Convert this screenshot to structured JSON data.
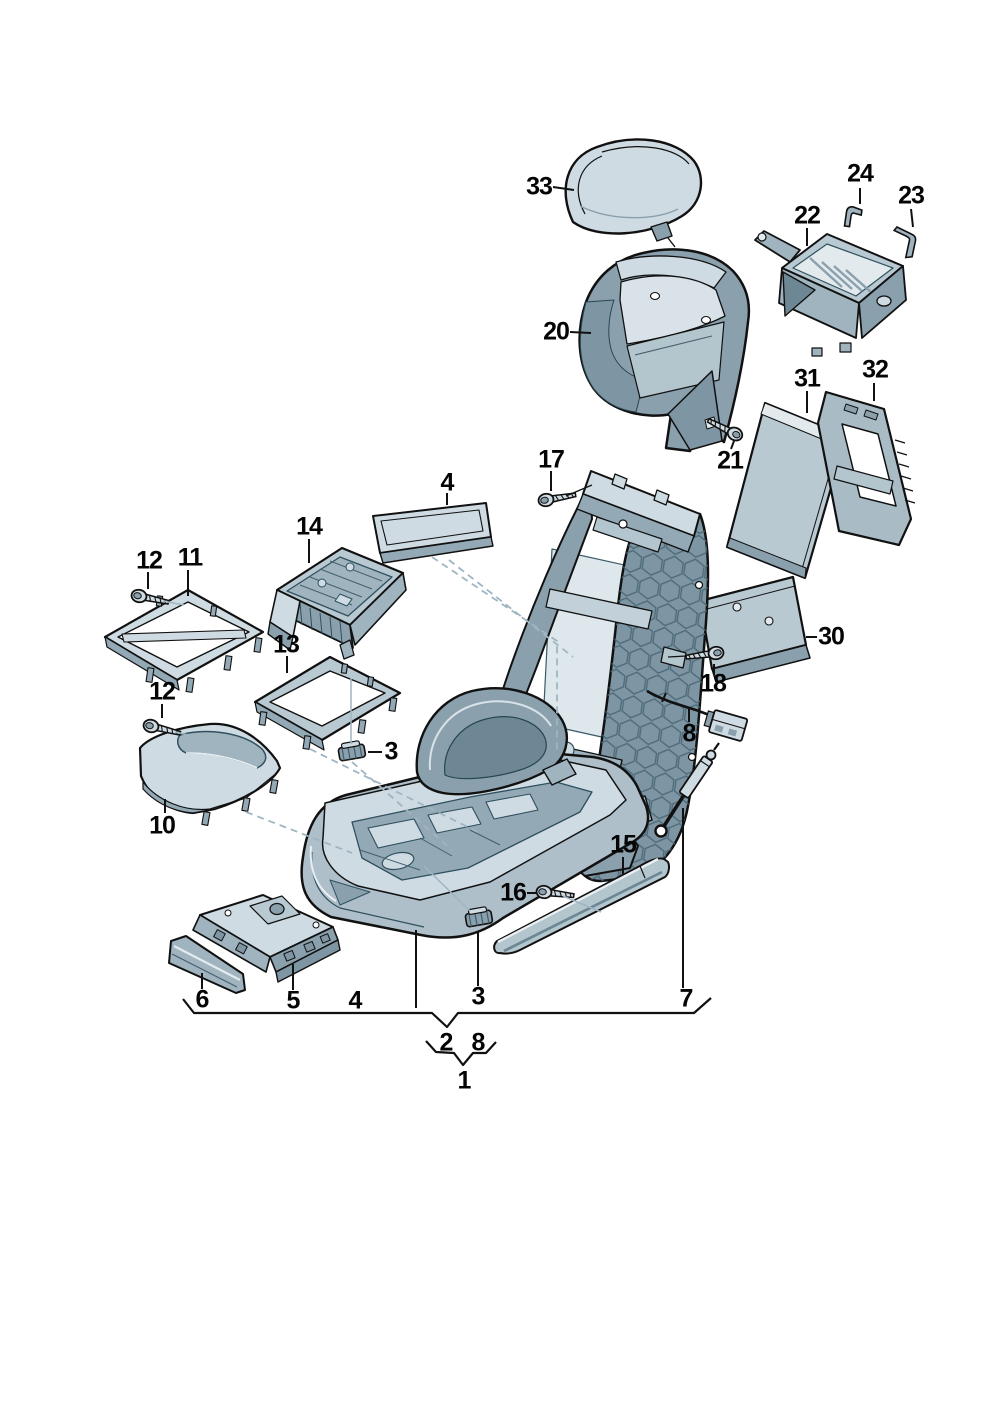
{
  "diagram": {
    "type": "exploded-parts-diagram",
    "background": "#ffffff",
    "colors": {
      "outline": "#111111",
      "part_light": "#cfdbe2",
      "part_lighter": "#e2eaee",
      "part_mid": "#aebfc9",
      "part_mid_dark": "#8aa0ad",
      "part_dark": "#7e95a3",
      "interior_dark": "#6d8795",
      "dashed_line": "#9fb6c2",
      "label_text": "#050505"
    },
    "callouts": [
      {
        "label": "33",
        "x": 539,
        "y": 187
      },
      {
        "label": "24",
        "x": 860,
        "y": 174
      },
      {
        "label": "23",
        "x": 911,
        "y": 196
      },
      {
        "label": "22",
        "x": 807,
        "y": 216
      },
      {
        "label": "20",
        "x": 556,
        "y": 332
      },
      {
        "label": "31",
        "x": 807,
        "y": 379
      },
      {
        "label": "32",
        "x": 875,
        "y": 370
      },
      {
        "label": "21",
        "x": 730,
        "y": 461
      },
      {
        "label": "17",
        "x": 551,
        "y": 460
      },
      {
        "label": "4",
        "x": 447,
        "y": 483
      },
      {
        "label": "14",
        "x": 309,
        "y": 527
      },
      {
        "label": "12",
        "x": 149,
        "y": 561
      },
      {
        "label": "11",
        "x": 190,
        "y": 558
      },
      {
        "label": "13",
        "x": 286,
        "y": 645
      },
      {
        "label": "12",
        "x": 162,
        "y": 692
      },
      {
        "label": "3",
        "x": 391,
        "y": 752
      },
      {
        "label": "10",
        "x": 162,
        "y": 826
      },
      {
        "label": "30",
        "x": 831,
        "y": 637
      },
      {
        "label": "18",
        "x": 713,
        "y": 684
      },
      {
        "label": "8",
        "x": 689,
        "y": 734
      },
      {
        "label": "15",
        "x": 623,
        "y": 845
      },
      {
        "label": "16",
        "x": 513,
        "y": 893
      },
      {
        "label": "6",
        "x": 202,
        "y": 1000
      },
      {
        "label": "5",
        "x": 293,
        "y": 1001
      },
      {
        "label": "4",
        "x": 355,
        "y": 1001
      },
      {
        "label": "3",
        "x": 478,
        "y": 997
      },
      {
        "label": "7",
        "x": 686,
        "y": 999
      },
      {
        "label": "2",
        "x": 446,
        "y": 1043
      },
      {
        "label": "8",
        "x": 478,
        "y": 1043
      },
      {
        "label": "1",
        "x": 464,
        "y": 1081
      }
    ]
  }
}
